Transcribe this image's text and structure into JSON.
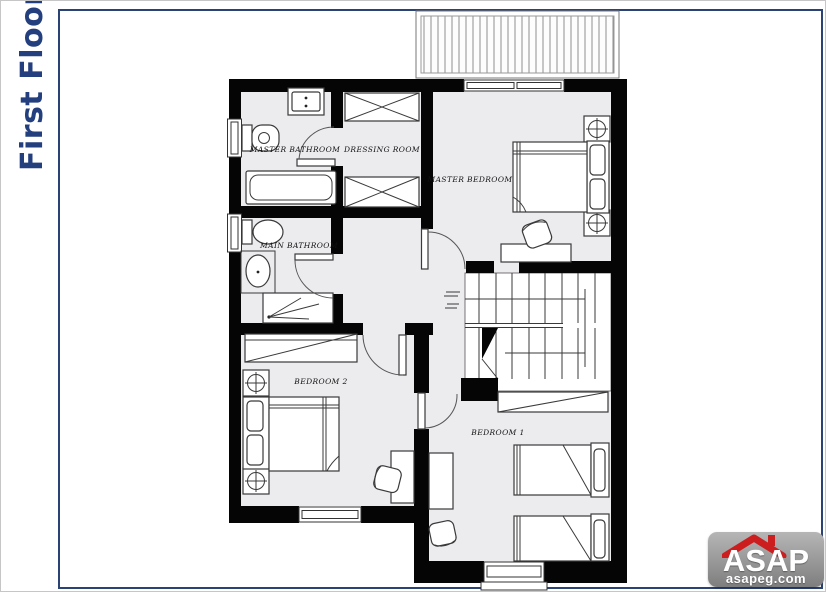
{
  "title": {
    "text": "First Floor",
    "color": "#243f7e"
  },
  "frame": {
    "color": "#2b4274"
  },
  "plan": {
    "rooms": [
      {
        "id": "master-bathroom",
        "label": "MASTER BATHROOM"
      },
      {
        "id": "dressing-room",
        "label": "DRESSING ROOM"
      },
      {
        "id": "master-bedroom",
        "label": "MASTER BEDROOM"
      },
      {
        "id": "main-bathroom",
        "label": "MAIN BATHROOM"
      },
      {
        "id": "bedroom-2",
        "label": "BEDROOM 2"
      },
      {
        "id": "bedroom-1",
        "label": "BEDROOM 1"
      }
    ],
    "colors": {
      "wall": "#050505",
      "floor": "#ecebee",
      "furniture_line": "#3a3a3a"
    }
  },
  "logo": {
    "name": "ASAP",
    "domain": "asapeg.com",
    "bg_color": "#8f8f8f",
    "roof_color": "#cc1e1e"
  }
}
